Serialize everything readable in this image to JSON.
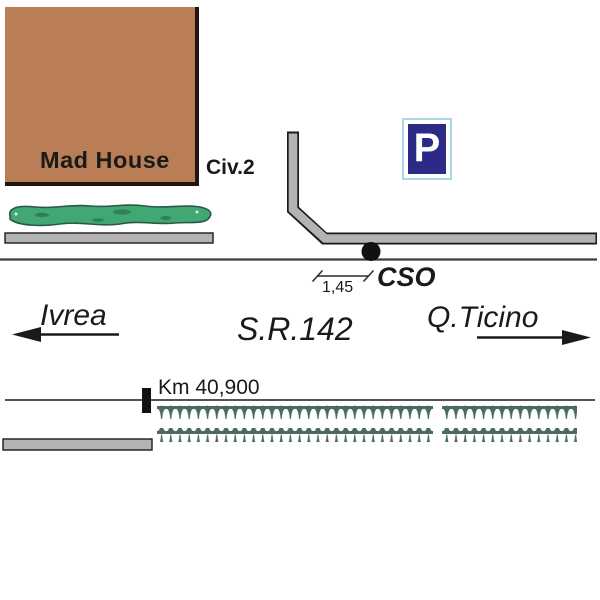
{
  "plan": {
    "building_label": "Mad House",
    "civic_label": "Civ.2",
    "parking_sign_letter": "P",
    "point_label": "CSO",
    "dimension_value": "1,45",
    "direction_left": "Ivrea",
    "road_name": "S.R.142",
    "direction_right": "Q.Ticino",
    "km_marker_label": "Km 40,900"
  },
  "colors": {
    "building_fill": "#B97E56",
    "hedge_green": "#41A873",
    "road_gray": "#B3B3B3",
    "outline_black": "#1A1A1A",
    "sign_navy": "#2B2B87",
    "sign_border_cyan": "#A8D8E8",
    "barrier_teal": "#4A6B60"
  }
}
